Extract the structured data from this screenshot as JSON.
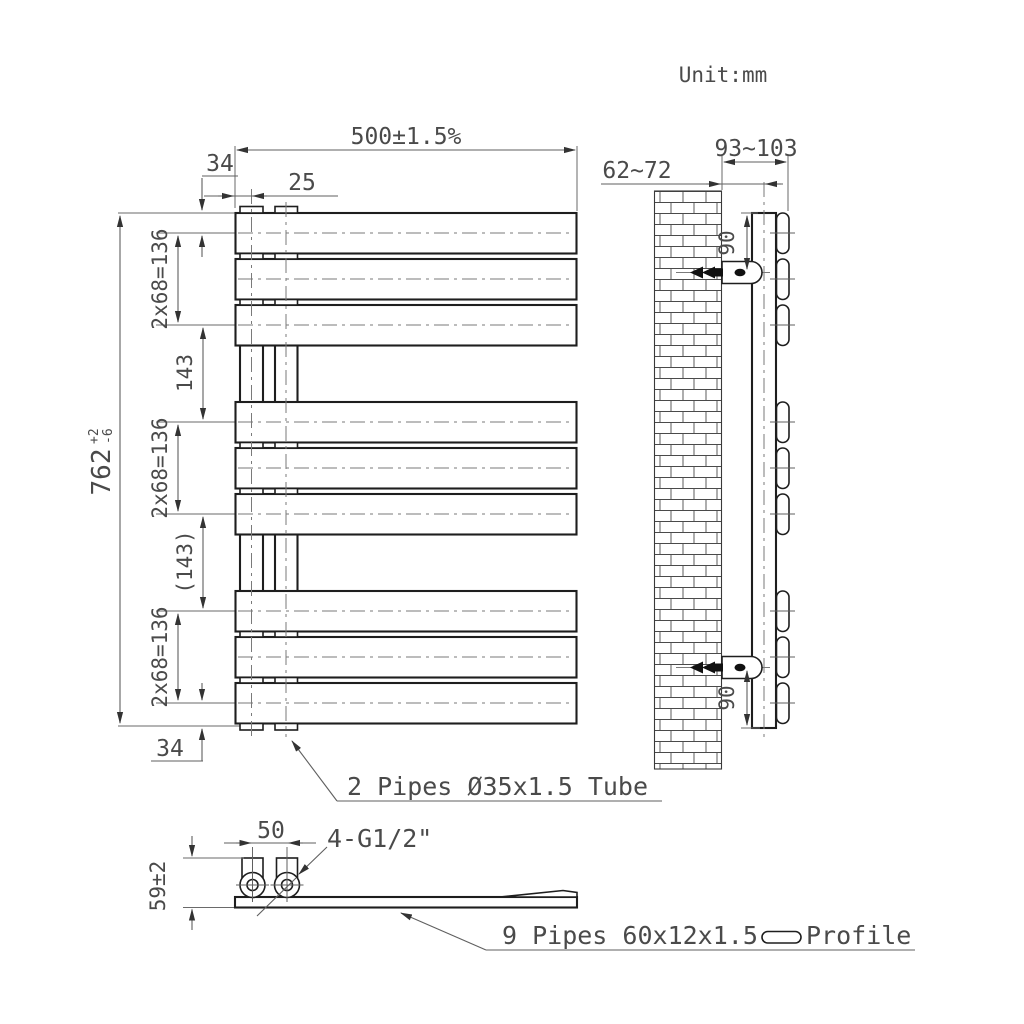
{
  "unit_label": "Unit:mm",
  "front_view": {
    "dim_width": "500±1.5%",
    "dim_top_offset": "34",
    "dim_pipe_inset": "25",
    "dim_height_value": "762",
    "dim_height_tol_plus": "+2",
    "dim_height_tol_minus": "-6",
    "dim_group_top": "2x68=136",
    "dim_gap_top": "143",
    "dim_group_middle": "2x68=136",
    "dim_gap_bottom": "(143)",
    "dim_group_bottom": "2x68=136",
    "dim_bottom_offset": "34",
    "pipe_note": "2 Pipes Ø35x1.5 Tube"
  },
  "side_view": {
    "dim_wall_clearance": "62~72",
    "dim_wall_to_front": "93~103",
    "dim_bracket_from_top": "90",
    "dim_bracket_from_bottom": "90"
  },
  "bottom_view": {
    "dim_pipe_spacing": "50",
    "dim_connector_height": "59±2",
    "thread_note": "4-G1/2\"",
    "profile_note": "9 Pipes 60x12x1.5",
    "profile_label": "Profile"
  }
}
